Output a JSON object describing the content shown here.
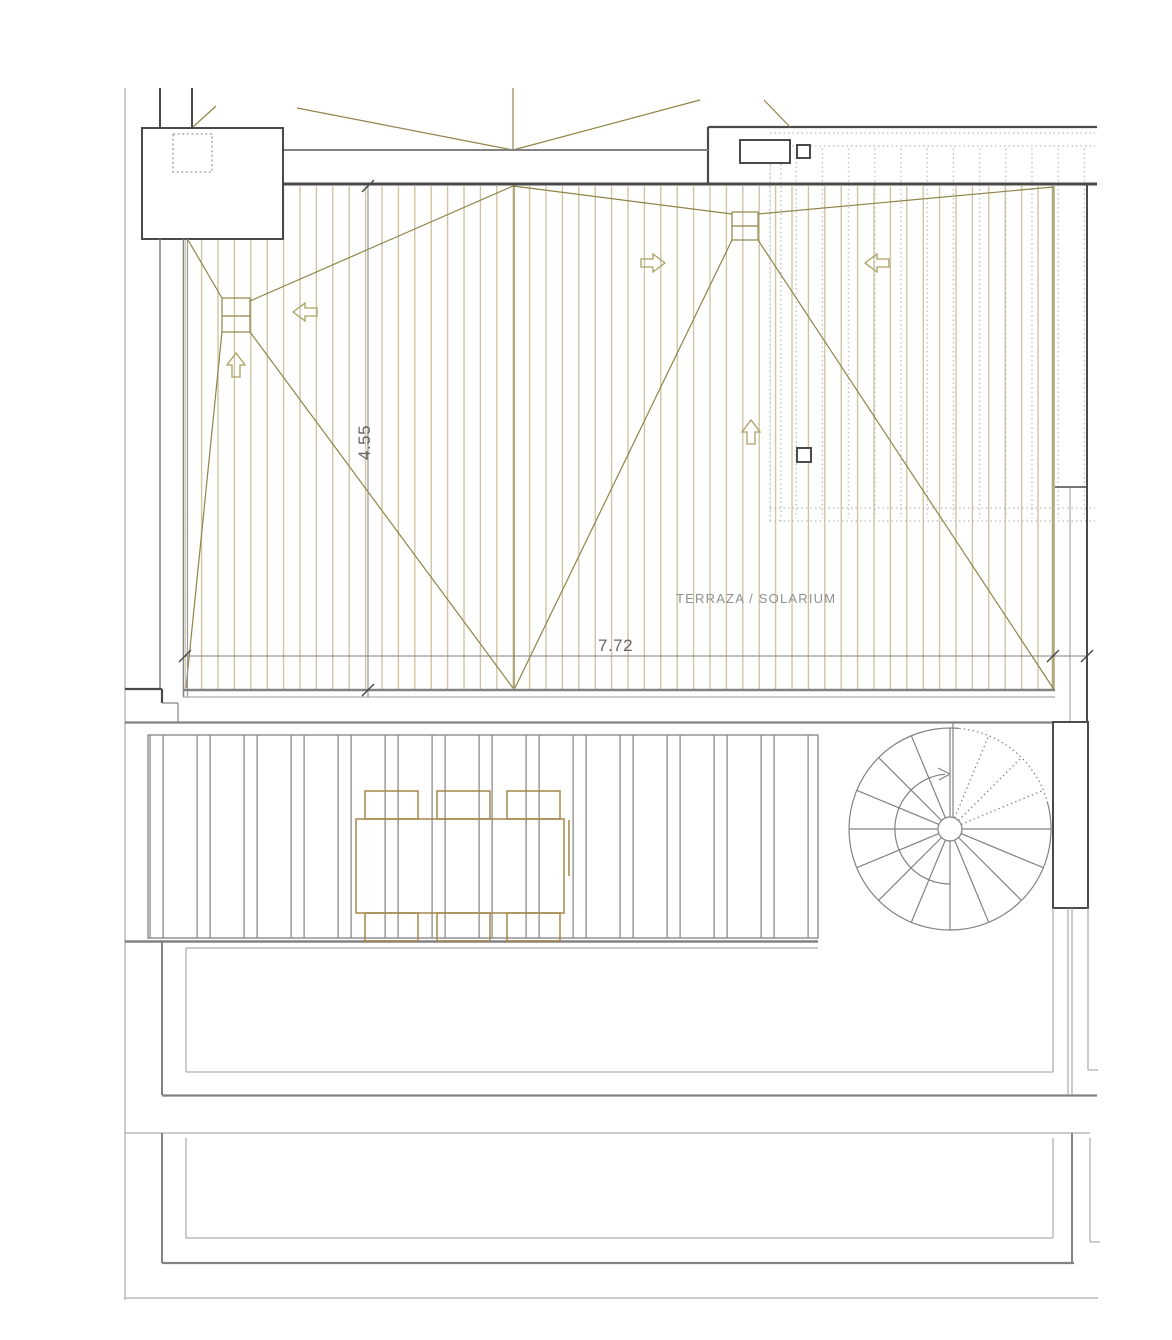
{
  "drawing": {
    "type": "architectural roof terrace plan",
    "room_label": "TERRAZA / SOLARIUM",
    "dim_width": "7.72",
    "dim_height": "4.55"
  },
  "icons": {
    "slope_arrows": [
      "slope-arrow-left-icon",
      "slope-arrow-right-icon",
      "slope-arrow-up-icon"
    ],
    "stair": "spiral-stair-direction-arrow-icon",
    "drains": [
      "roof-drain-left",
      "roof-drain-middle"
    ]
  },
  "colors": {
    "deck_board": "#c6bc92",
    "deck_edge": "#b0a678",
    "slope_line": "#8f8448",
    "arrow": "#ab9f63",
    "furniture": "#a4874a",
    "wall_dark": "#4a4a4a",
    "line_medium": "#828282",
    "line_light": "#9a9a9a",
    "dotted": "#b9b9b9",
    "text": "#8f8f8f",
    "dim_text": "#666666"
  }
}
